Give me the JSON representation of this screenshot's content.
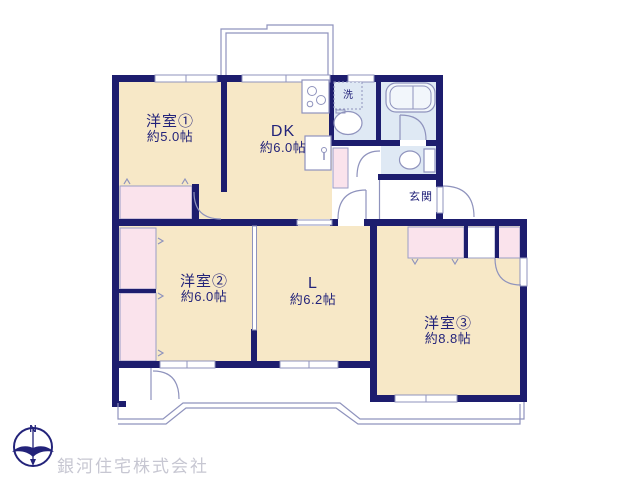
{
  "rooms": [
    {
      "name": "洋室①",
      "area": "約5.0帖"
    },
    {
      "name": "DK",
      "area": "約6.0帖"
    },
    {
      "name": "洋室②",
      "area": "約6.0帖"
    },
    {
      "name": "L",
      "area": "約6.2帖"
    },
    {
      "name": "洋室③",
      "area": "約8.8帖"
    }
  ],
  "labels": {
    "entrance": "玄関",
    "washing_machine": "洗",
    "compass_north": "N"
  },
  "branding": {
    "company_name": "銀河住宅株式会社"
  },
  "colors": {
    "wall": "#1d1d6e",
    "room_floor": "#f7e8c7",
    "closet": "#fae3ec",
    "wet_area": "#dfe9f4",
    "thin_line": "#8f93bd",
    "label_text": "#23237a",
    "watermark": "#c7c7d2"
  }
}
